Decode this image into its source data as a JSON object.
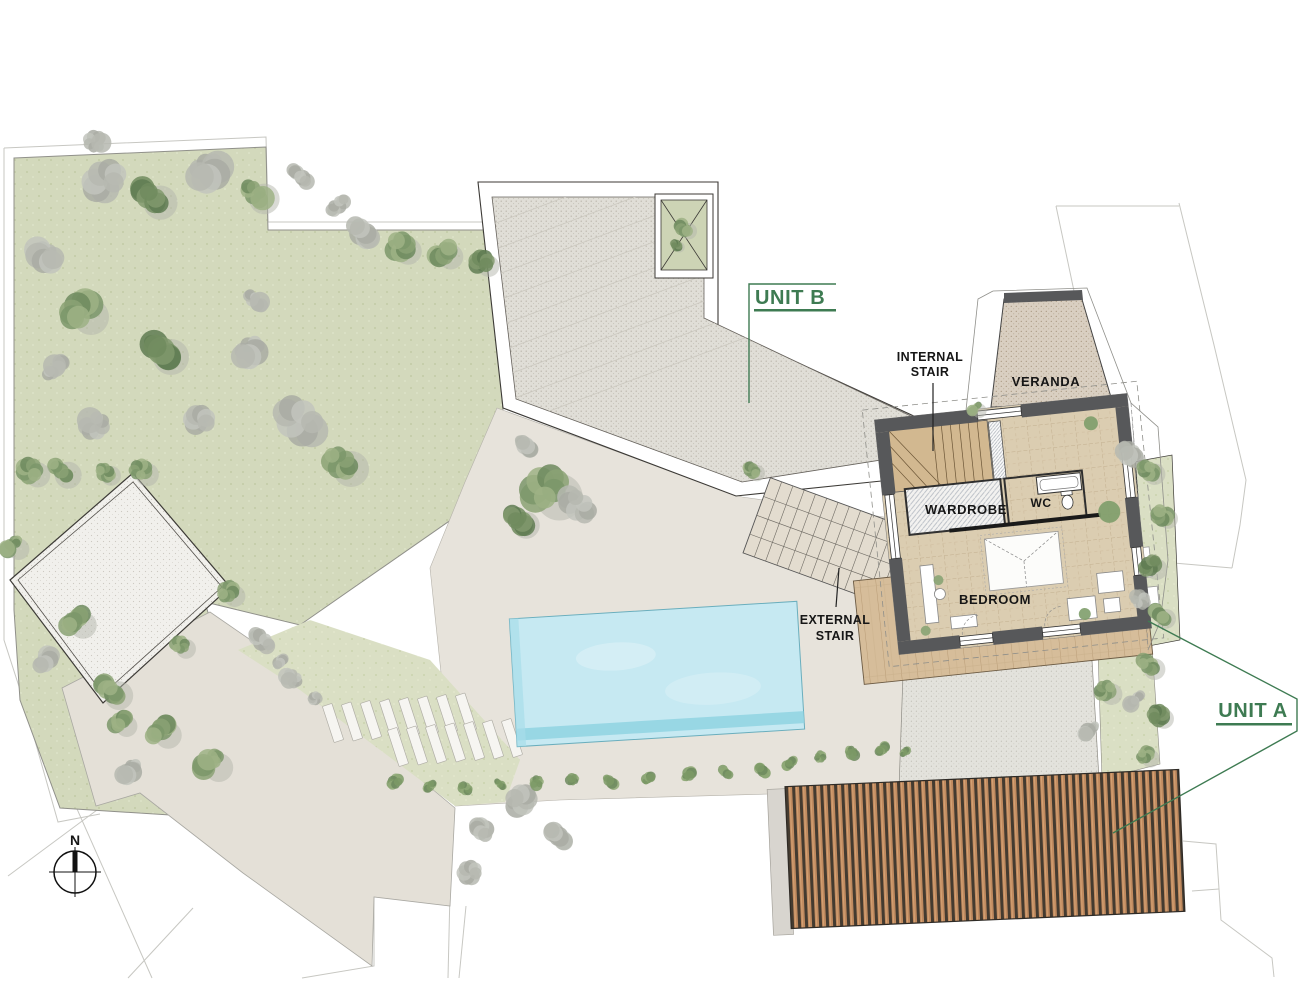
{
  "plan": {
    "labels": {
      "unit_a": "UNIT A",
      "unit_b": "UNIT B",
      "internal_stair": [
        "INTERNAL",
        "STAIR"
      ],
      "external_stair": [
        "EXTERNAL",
        "STAIR"
      ],
      "veranda": "VERANDA",
      "wardrobe": "WARDROBE",
      "wc": "WC",
      "bedroom": "BEDROOM"
    },
    "compass": {
      "north_label": "N"
    },
    "colors": {
      "accent_green": "#3e7b52",
      "wall_gray": "#57585a",
      "pool_blue": "#c6e9f2",
      "pool_edge": "#8fd4e2",
      "garden_green": "#d3d9bc",
      "lawn_green": "#dadfc4",
      "terrace_beige": "#e7e3db",
      "path_beige": "#e4e0d7",
      "deck_wood": "#d6bd9a",
      "slat_wood": "#c08a5f",
      "slat_gap": "#443b30",
      "roof_stipple": "#e0ded7",
      "veranda_stipple": "#d9cfc1",
      "ink": "#161616",
      "boundary_gray": "#c7c7c2"
    }
  }
}
